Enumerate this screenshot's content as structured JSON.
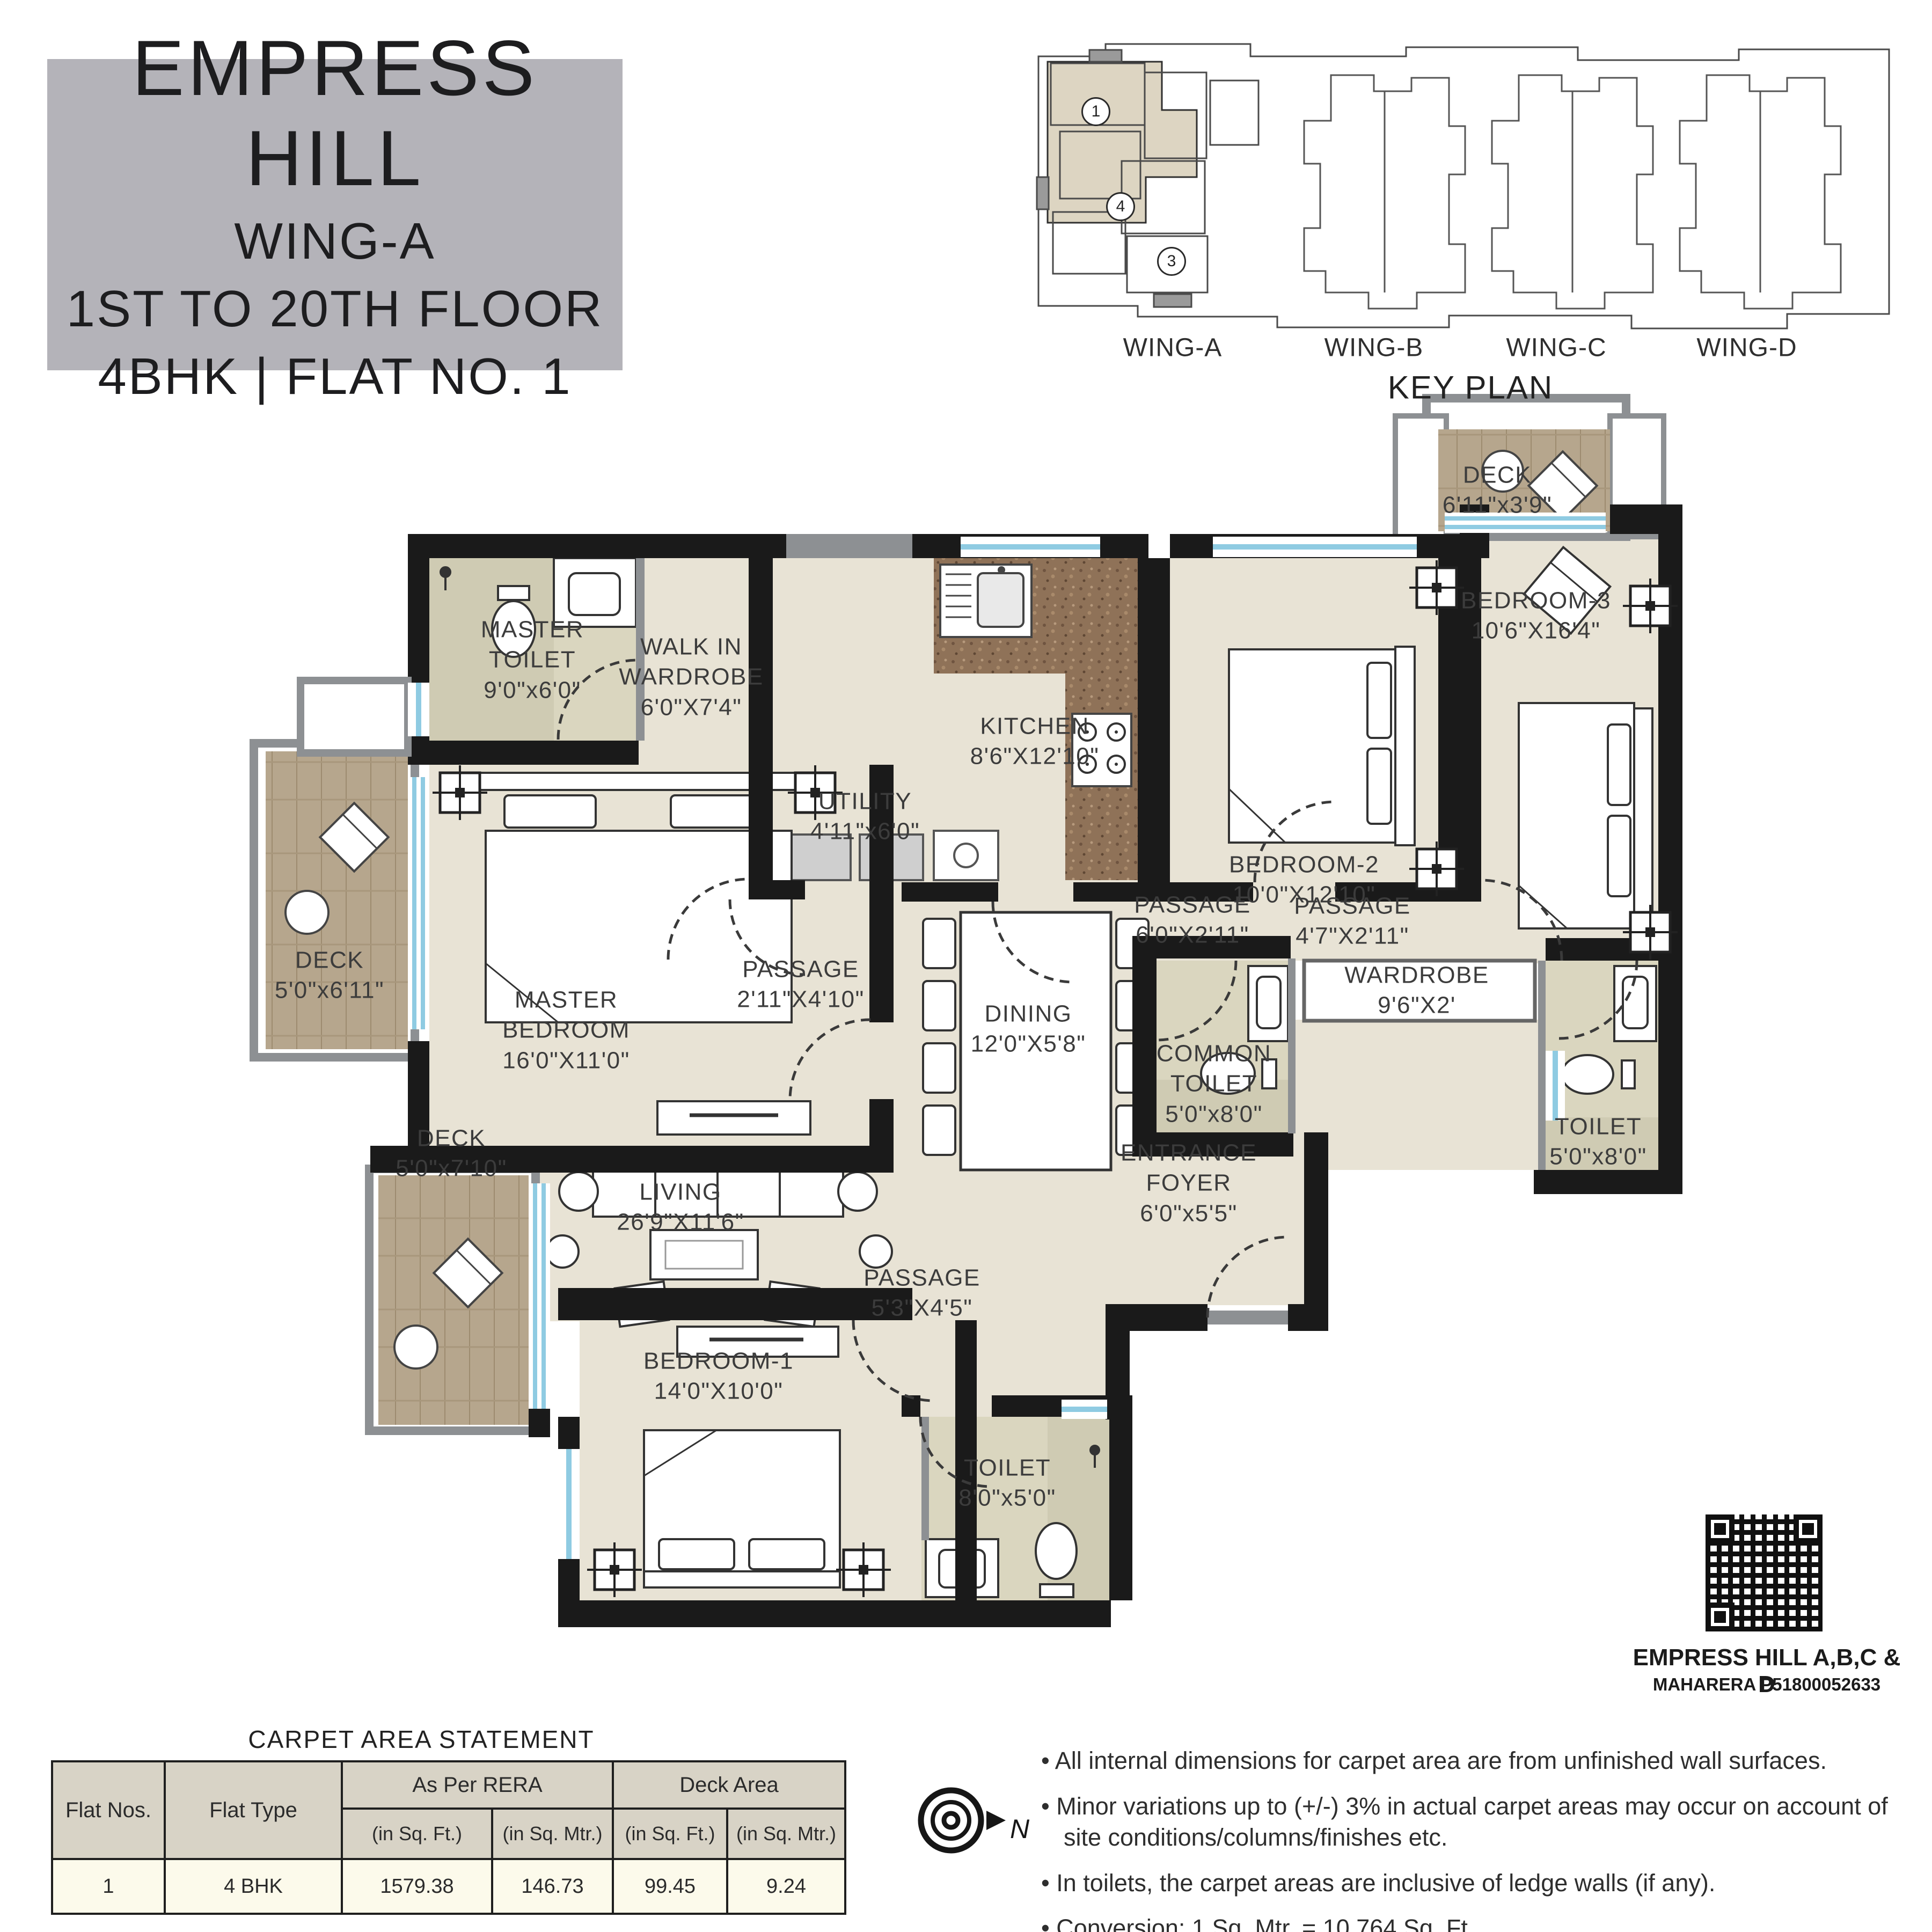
{
  "title_block": {
    "project": "EMPRESS HILL",
    "wing": "WING-A",
    "floors": "1ST TO 20TH FLOOR",
    "unit": "4BHK | FLAT NO. 1"
  },
  "key_plan": {
    "caption": "KEY PLAN",
    "wings": [
      "WING-A",
      "WING-B",
      "WING-C",
      "WING-D"
    ],
    "markers": [
      "1",
      "4",
      "3"
    ]
  },
  "plan": {
    "rooms": {
      "master_toilet": "MASTER\nTOILET\n9'0\"x6'0\"",
      "walkin": "WALK IN\nWARDROBE\n6'0\"X7'4\"",
      "kitchen": "KITCHEN\n8'6\"X12'10\"",
      "utility": "UTILITY\n4'11\"x6'0\"",
      "bedroom2": "BEDROOM-2\n10'0\"X12'10\"",
      "bedroom3": "BEDROOM-3\n10'6\"X16'4\"",
      "deck3": "DECK\n6'11\"x3'9\"",
      "deck_left": "DECK\n5'0\"x6'11\"",
      "master_bedroom": "MASTER\nBEDROOM\n16'0\"X11'0\"",
      "passage1": "PASSAGE\n2'11\"X4'10\"",
      "passage2": "PASSAGE\n6'0\"X2'11\"",
      "passage3": "PASSAGE\n4'7\"X2'11\"",
      "wardrobe": "WARDROBE\n9'6\"X2'",
      "common_toilet": "COMMON\nTOILET\n5'0\"x8'0\"",
      "toilet_right": "TOILET\n5'0\"x8'0\"",
      "dining": "DINING\n12'0\"X5'8\"",
      "entrance": "ENTRANCE\nFOYER\n6'0\"x5'5\"",
      "deck_left2": "DECK\n5'0\"x7'10\"",
      "living": "LIVING\n26'9\"X11'6\"",
      "bedroom1": "BEDROOM-1\n14'0\"X10'0\"",
      "passage4": "PASSAGE\n5'3\"X4'5\"",
      "toilet_bottom": "TOILET\n8'0\"x5'0\""
    }
  },
  "qr": {
    "title": "EMPRESS HILL A,B,C & D",
    "rera": "MAHARERA P51800052633"
  },
  "carpet_table": {
    "title": "CARPET AREA STATEMENT",
    "flat_nos": "Flat Nos.",
    "flat_type": "Flat Type",
    "rera_group": "As Per RERA",
    "deck_group": "Deck Area",
    "subheaders": [
      "(in Sq. Ft.)",
      "(in Sq. Mtr.)",
      "(in Sq. Ft.)",
      "(in Sq. Mtr.)"
    ],
    "row": [
      "1",
      "4 BHK",
      "1579.38",
      "146.73",
      "99.45",
      "9.24"
    ]
  },
  "notes": [
    "• All internal dimensions for carpet area are from unfinished wall surfaces.",
    "• Minor variations up to (+/-) 3% in actual carpet areas may occur on account of site conditions/columns/finishes etc.",
    "• In toilets, the carpet areas are inclusive of ledge walls (if any).",
    "• Conversion: 1 Sq. Mtr. = 10.764 Sq. Ft."
  ],
  "compass": {
    "north": "N"
  }
}
